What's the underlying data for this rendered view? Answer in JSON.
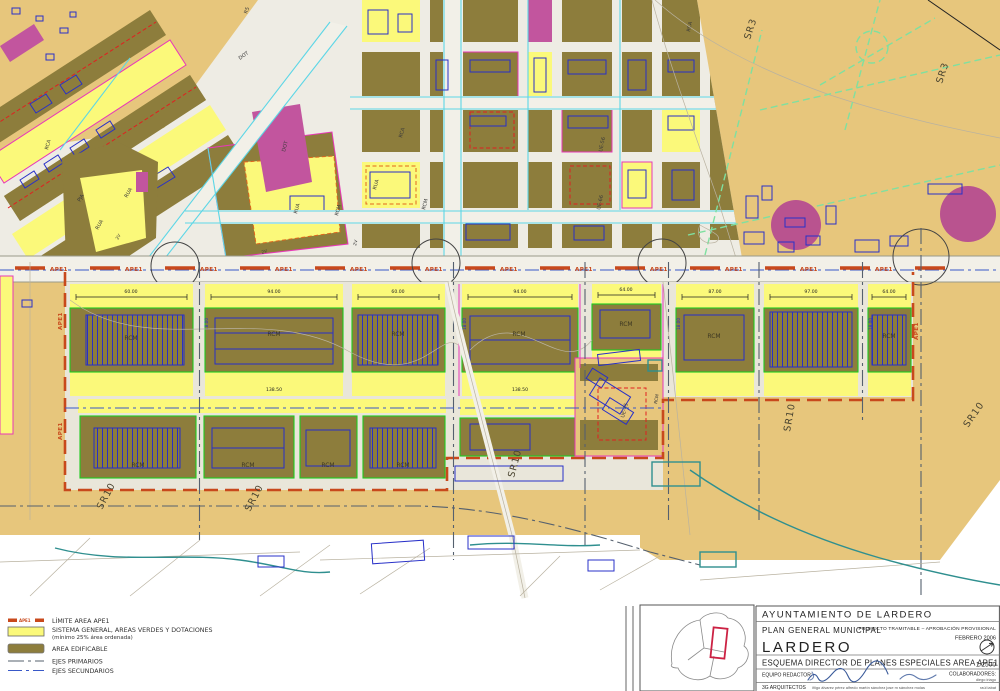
{
  "map": {
    "labels": {
      "ape1": "APE1",
      "sr3": "SR3",
      "sr10": "SR10",
      "rcm": "RCM",
      "rca": "RCA",
      "rua": "RUA",
      "pja": "PJA",
      "dot": "DOT",
      "r5": "R5",
      "ue56": "UE-56",
      "ue66": "UE-66",
      "ue45": "UE-45",
      "v2": "2V"
    },
    "dimensions": {
      "b1": "60.00",
      "b2": "94.00",
      "b3": "60.00",
      "b4": "94.00",
      "b5": "64.00",
      "b6": "87.00",
      "b7": "97.00",
      "b8": "64.00",
      "bottom1": "138.50",
      "bottom2": "138.50",
      "small": "18.00"
    }
  },
  "legend": {
    "limit_label": "LÍMITE AREA APE1",
    "sg_label": "SISTEMA GENERAL, AREAS VERDES Y DOTACIONES",
    "sg_sublabel": "(mínimo 25% área ordenada)",
    "edificable_label": "AREA EDIFICABLE",
    "ejes_primarios_label": "EJES PRIMARIOS",
    "ejes_secundarios_label": "EJES SECUNDARIOS",
    "swatch_ape1_text": "APE1"
  },
  "titleblock": {
    "municipality": "AYUNTAMIENTO DE LARDERO",
    "plan": "PLAN GENERAL MUNICIPAL",
    "status": "PROYECTO TRAMITABLE – APROBACIÓN PROVISIONAL",
    "date": "FEBRERO 2006",
    "city": "LARDERO",
    "sheet_title": "ESQUEMA DIRECTOR DE PLANES ESPECIALES AREA APE1",
    "scale": "1/2500",
    "equipo_label": "EQUIPO REDACTOR:",
    "colaboradores_label": "COLABORADORES:",
    "firm": "3G ARQUITECTOS",
    "team_names": "iñigo álvarez pérez    alfredo martín sánchez    jose m sánchez molas",
    "colab_name1": "diego iriago",
    "colab_name2": "raúl iabat"
  },
  "colors": {
    "tan": "#e7c67c",
    "olive": "#8d7d3c",
    "yellow": "#fbf97a",
    "magenta_fill": "#c2559e",
    "magenta_line": "#e838b8",
    "cyan_street": "#5cd6e6",
    "green_border": "#1ecb1e",
    "green_dash": "#7fe0a0",
    "ape1_line": "#c8491c",
    "red_dash": "#e02020",
    "blue_building": "#2830c8",
    "teal": "#2f8f8f",
    "axis_dark": "#55606e",
    "axis_blue": "#3858c8"
  }
}
